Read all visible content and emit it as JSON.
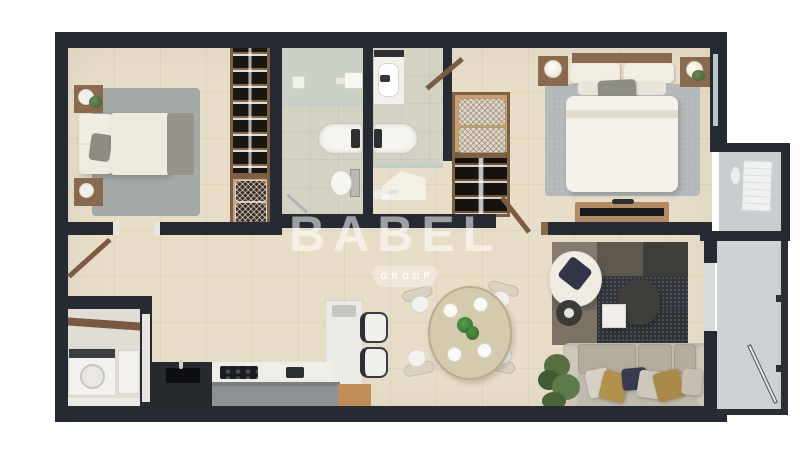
{
  "meta": {
    "type": "3d-floor-plan-rendering",
    "view": "top-down"
  },
  "watermark": {
    "brand": "BABEL",
    "subtitle": "GROUP",
    "icon": "babel-house-shield-logo"
  },
  "palette": {
    "wall": "#262b33",
    "rail": "#2a2e35",
    "floor": "#e8ddc7",
    "bath": "#d5d2c3",
    "shower": "#cbd0c4",
    "glass": "#c3cfc9",
    "balc": "#ced2d4",
    "utility": "#e0ddd5",
    "wood": "#8a6a4c",
    "woodlt": "#c9a170",
    "woodacc": "#c08d58",
    "whitefurn": "#f2efe8",
    "gray": "#8e9296",
    "dark": "#26292e",
    "rug1": "#a4a9a6",
    "rug2": "#b4b8ba",
    "sofa": "#c0b9ad",
    "navy": "#383a50",
    "gold": "#b2914c",
    "green": "#5d7a4a",
    "wm": "rgba(255,255,255,0.55)"
  },
  "rooms": [
    {
      "name": "bedroom-1",
      "furniture": [
        "double-bed",
        "nightstand-with-lamp",
        "nightstand-with-lamp",
        "area-rug",
        "wardrobe-folded-clothes",
        "shelf-with-wicker-baskets"
      ]
    },
    {
      "name": "bathroom-1",
      "furniture": [
        "walk-in-shower",
        "bathtub",
        "wall-sink",
        "toilet",
        "towel-rail"
      ]
    },
    {
      "name": "bathroom-2",
      "furniture": [
        "vanity-sink",
        "bathtub",
        "glass-partition"
      ]
    },
    {
      "name": "walk-in-closet",
      "furniture": [
        "cushion-shelf",
        "hanging-clothes-rail"
      ]
    },
    {
      "name": "master-bedroom",
      "furniture": [
        "double-bed",
        "nightstand-with-lamp",
        "nightstand-with-lamp",
        "area-rug",
        "tv-bench",
        "window"
      ]
    },
    {
      "name": "living-room",
      "furniture": [
        "armchair",
        "side-table",
        "coffee-table",
        "small-table",
        "patterned-rug",
        "sofa-with-cushions",
        "plant"
      ]
    },
    {
      "name": "dining-area",
      "furniture": [
        "oval-table",
        "chair",
        "chair",
        "chair",
        "chair",
        "place-settings",
        "plant-centerpiece"
      ]
    },
    {
      "name": "kitchen",
      "furniture": [
        "island-with-sink",
        "cooktop-counter",
        "cabinet-run",
        "peninsula",
        "bar-stool",
        "bar-stool"
      ]
    },
    {
      "name": "utility-room",
      "furniture": [
        "washing-machine",
        "cabinet",
        "wall-shelf",
        "doormat"
      ]
    },
    {
      "name": "utility-balcony",
      "furniture": [
        "ac-unit"
      ]
    },
    {
      "name": "balcony",
      "furniture": [
        "glass-railing",
        "glass-door"
      ]
    }
  ]
}
